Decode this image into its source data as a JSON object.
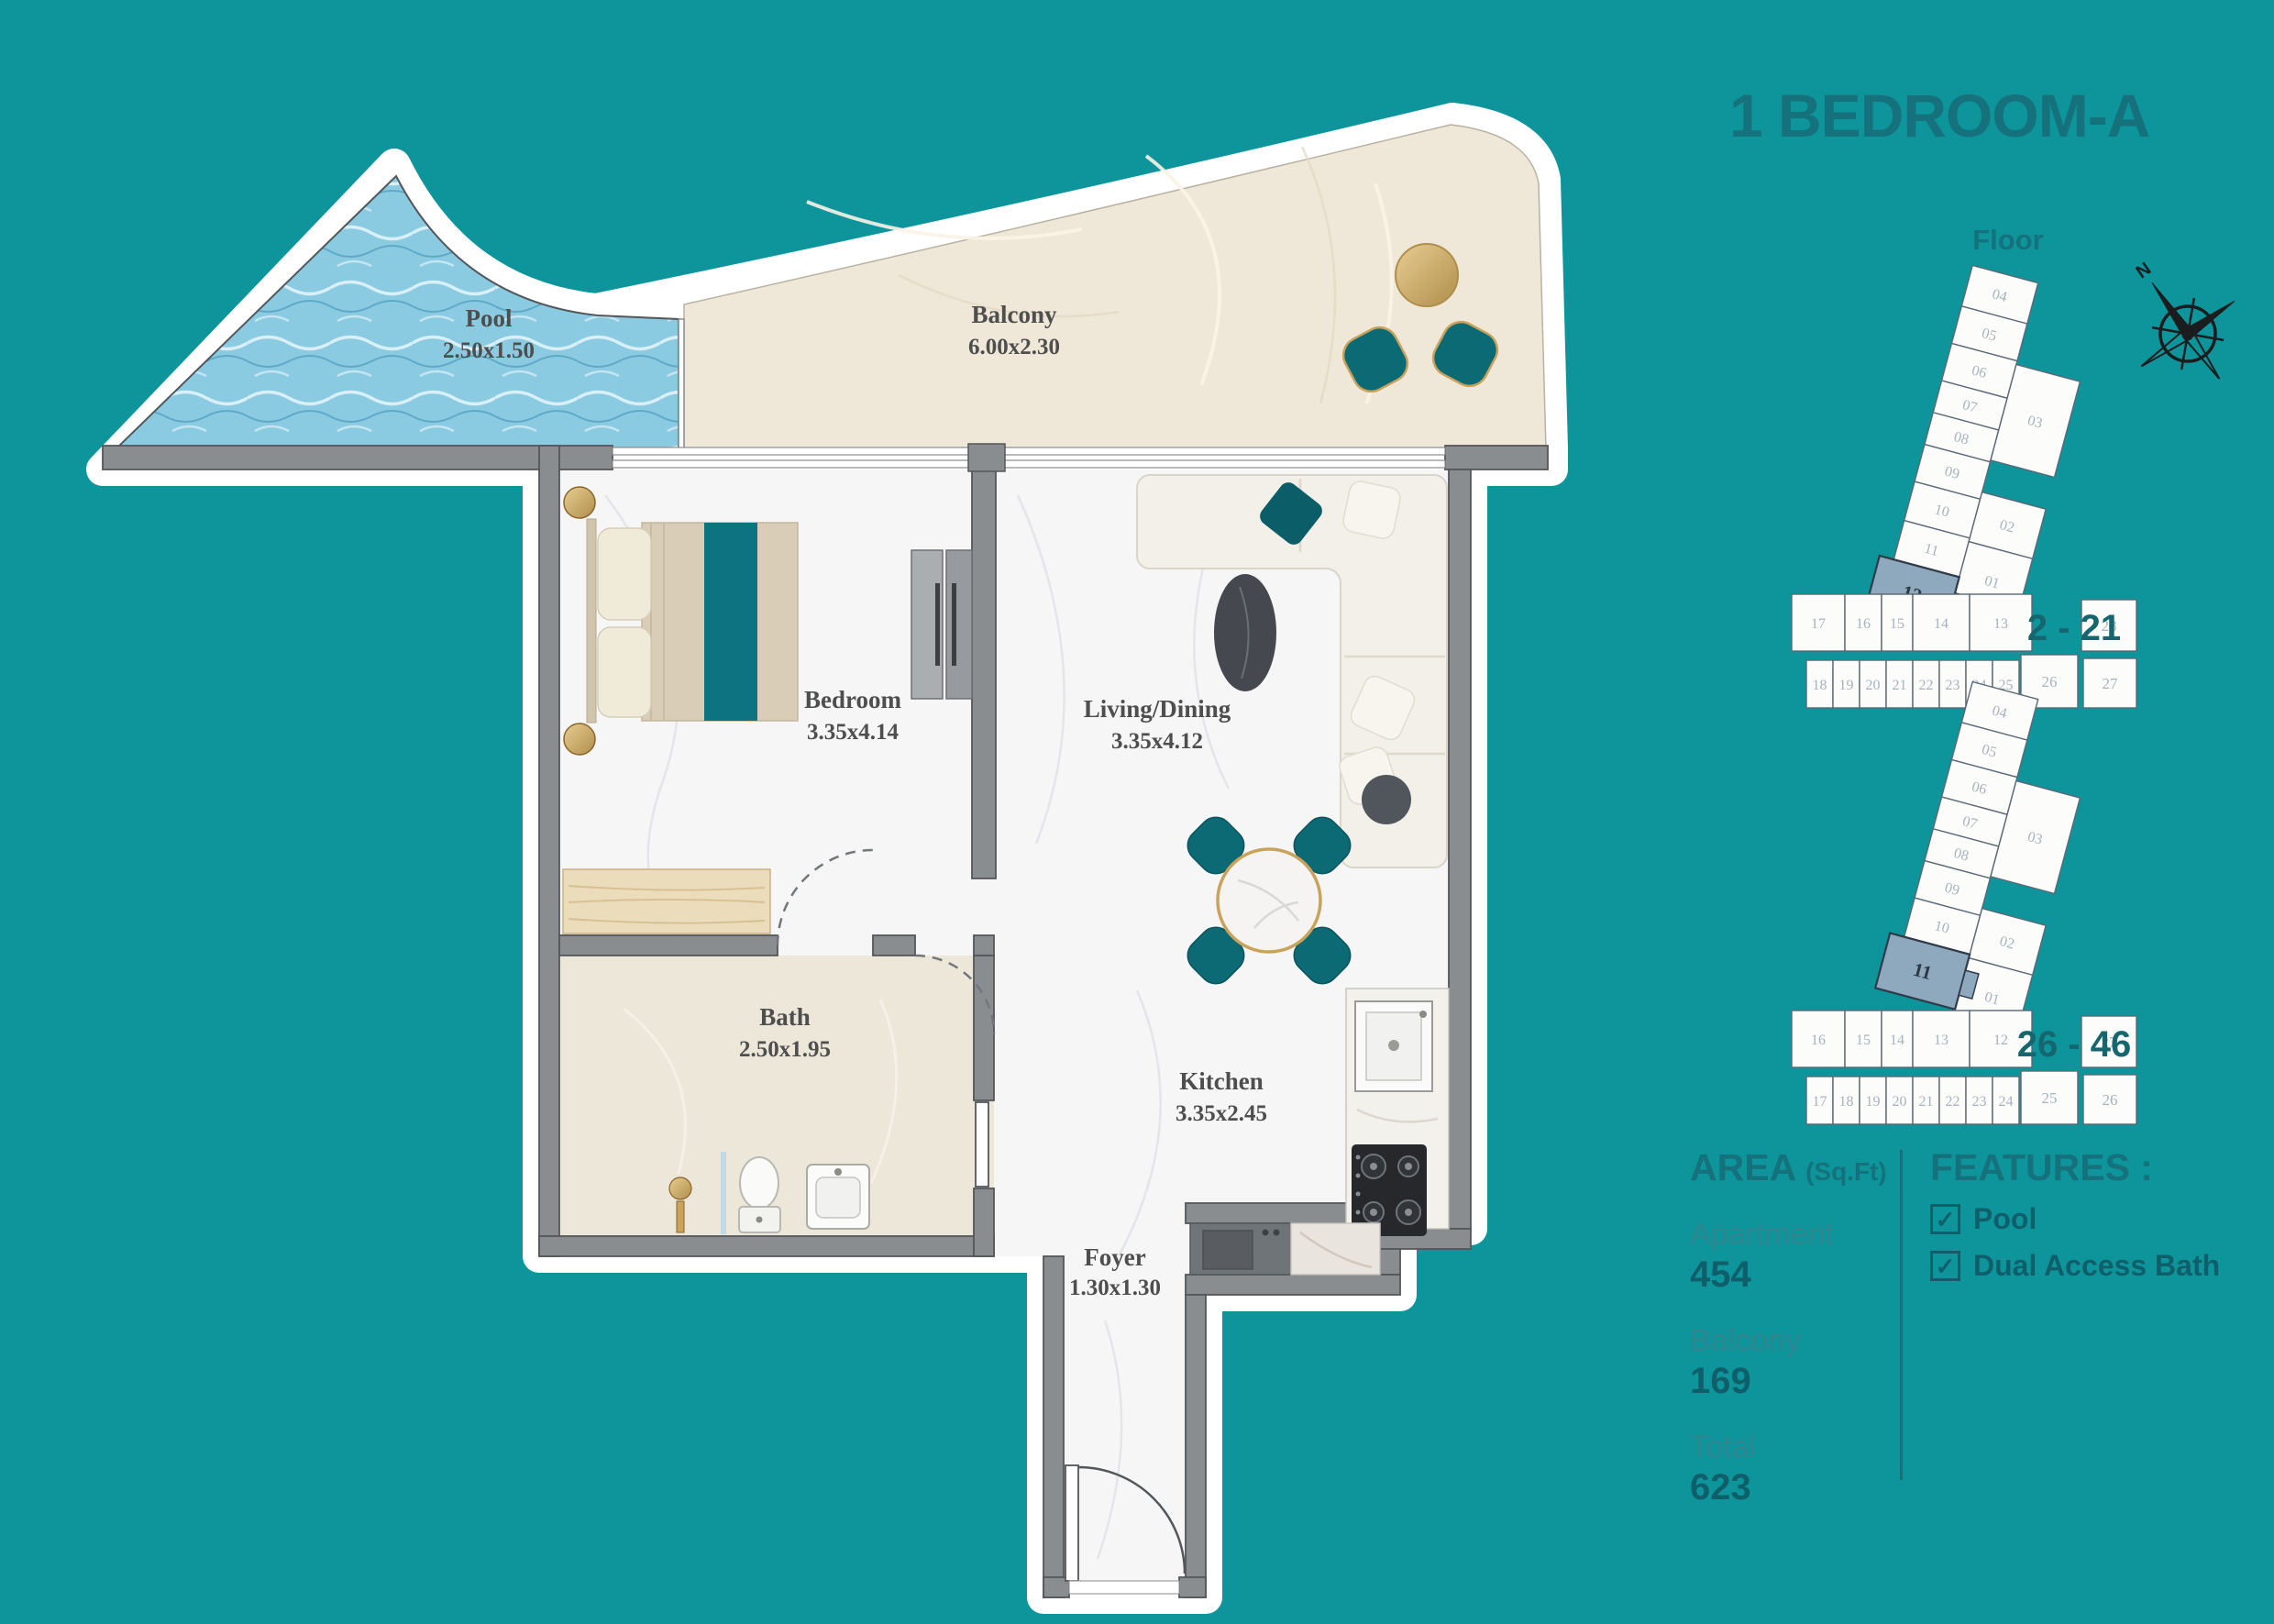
{
  "title": "1 BEDROOM-A",
  "floor_section": {
    "heading": "Floor",
    "compass_north": "N"
  },
  "plan": {
    "rooms": {
      "pool": {
        "name": "Pool",
        "dims": "2.50x1.50"
      },
      "balcony": {
        "name": "Balcony",
        "dims": "6.00x2.30"
      },
      "bedroom": {
        "name": "Bedroom",
        "dims": "3.35x4.14"
      },
      "living": {
        "name": "Living/Dining",
        "dims": "3.35x4.12"
      },
      "bath": {
        "name": "Bath",
        "dims": "2.50x1.95"
      },
      "kitchen": {
        "name": "Kitchen",
        "dims": "3.35x2.45"
      },
      "foyer": {
        "name": "Foyer",
        "dims": "1.30x1.30"
      }
    }
  },
  "floor_diagrams": [
    {
      "label": "2 - 21",
      "highlighted": "12",
      "tower_left": [
        "04",
        "05",
        "06",
        "07",
        "08",
        "09",
        "10",
        "11"
      ],
      "tower_right": [
        "03",
        "02",
        "01"
      ],
      "row_a": [
        "17",
        "16",
        "15",
        "14",
        "13"
      ],
      "row_b": [
        "18",
        "19",
        "20",
        "21",
        "22",
        "23",
        "24",
        "25",
        "26",
        "27"
      ],
      "corner": "28"
    },
    {
      "label": "26 - 46",
      "highlighted": "11",
      "tower_left": [
        "04",
        "05",
        "06",
        "07",
        "08",
        "09",
        "10"
      ],
      "tower_right": [
        "03",
        "02",
        "01"
      ],
      "row_a": [
        "16",
        "15",
        "14",
        "13",
        "12"
      ],
      "row_b": [
        "17",
        "18",
        "19",
        "20",
        "21",
        "22",
        "23",
        "24",
        "25",
        "26"
      ],
      "corner": "27"
    }
  ],
  "area": {
    "heading": "AREA",
    "heading_unit": "(Sq.Ft)",
    "rows": [
      {
        "label": "Apartment",
        "value": "454"
      },
      {
        "label": "Balcony",
        "value": "169"
      },
      {
        "label": "Total",
        "value": "623"
      }
    ]
  },
  "features": {
    "heading": "FEATURES :",
    "items": [
      "Pool",
      "Dual Access Bath"
    ],
    "checked": "✓"
  },
  "colors": {
    "background": "#0E959B",
    "accent": "#15717B",
    "value_text": "#0F5F6B",
    "highlight_unit": "#8EA8BD",
    "pool_water": "#8BCBE2",
    "balcony_floor": "#EFE7D8",
    "wall": "#8A8D90",
    "teal_furniture": "#0C6A74",
    "gold": "#C9A35C"
  }
}
